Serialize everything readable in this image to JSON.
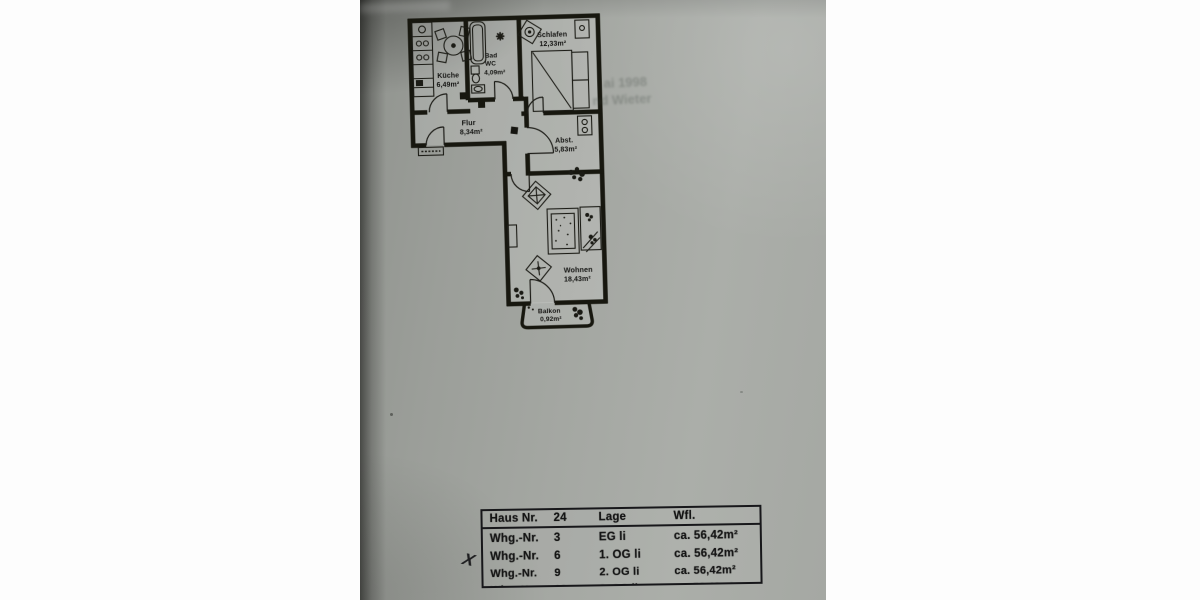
{
  "floorplan": {
    "rooms": {
      "kueche": {
        "name": "Küche",
        "area": "6,49m²"
      },
      "bad": {
        "name1": "Bad",
        "name2": "WC",
        "area": "4,09m²"
      },
      "schlafen": {
        "name": "Schlafen",
        "area": "12,33m²"
      },
      "flur": {
        "name": "Flur",
        "area": "8,34m²"
      },
      "abst": {
        "name": "Abst.",
        "area": "5,83m²"
      },
      "wohnen": {
        "name": "Wohnen",
        "area": "18,43m²"
      },
      "balkon": {
        "name": "Balkon",
        "area": "0,92m²"
      }
    },
    "ink_color": "#17170f",
    "paper_color": "#a4a7a2"
  },
  "bleed_through": {
    "line1": "ai 1998",
    "line2": "nd Wieter"
  },
  "table": {
    "header": {
      "label": "Haus Nr.",
      "number": "24",
      "lage": "Lage",
      "wfl": "Wfl."
    },
    "rows": [
      {
        "label": "Whg.-Nr.",
        "number": "3",
        "lage": "EG li",
        "wfl": "ca. 56,42m²",
        "marked": false,
        "struck": false
      },
      {
        "label": "Whg.-Nr.",
        "number": "6",
        "lage": "1. OG li",
        "wfl": "ca. 56,42m²",
        "marked": false,
        "struck": false
      },
      {
        "label": "Whg.-Nr.",
        "number": "9",
        "lage": "2. OG li",
        "wfl": "ca. 56,42m²",
        "marked": true,
        "struck": false
      },
      {
        "label": "Whg.-Nr.",
        "number": "12",
        "lage": "3. OG li",
        "wfl": "ca. 56,42m²",
        "marked": false,
        "struck": true
      }
    ],
    "mark_symbol": "X"
  }
}
